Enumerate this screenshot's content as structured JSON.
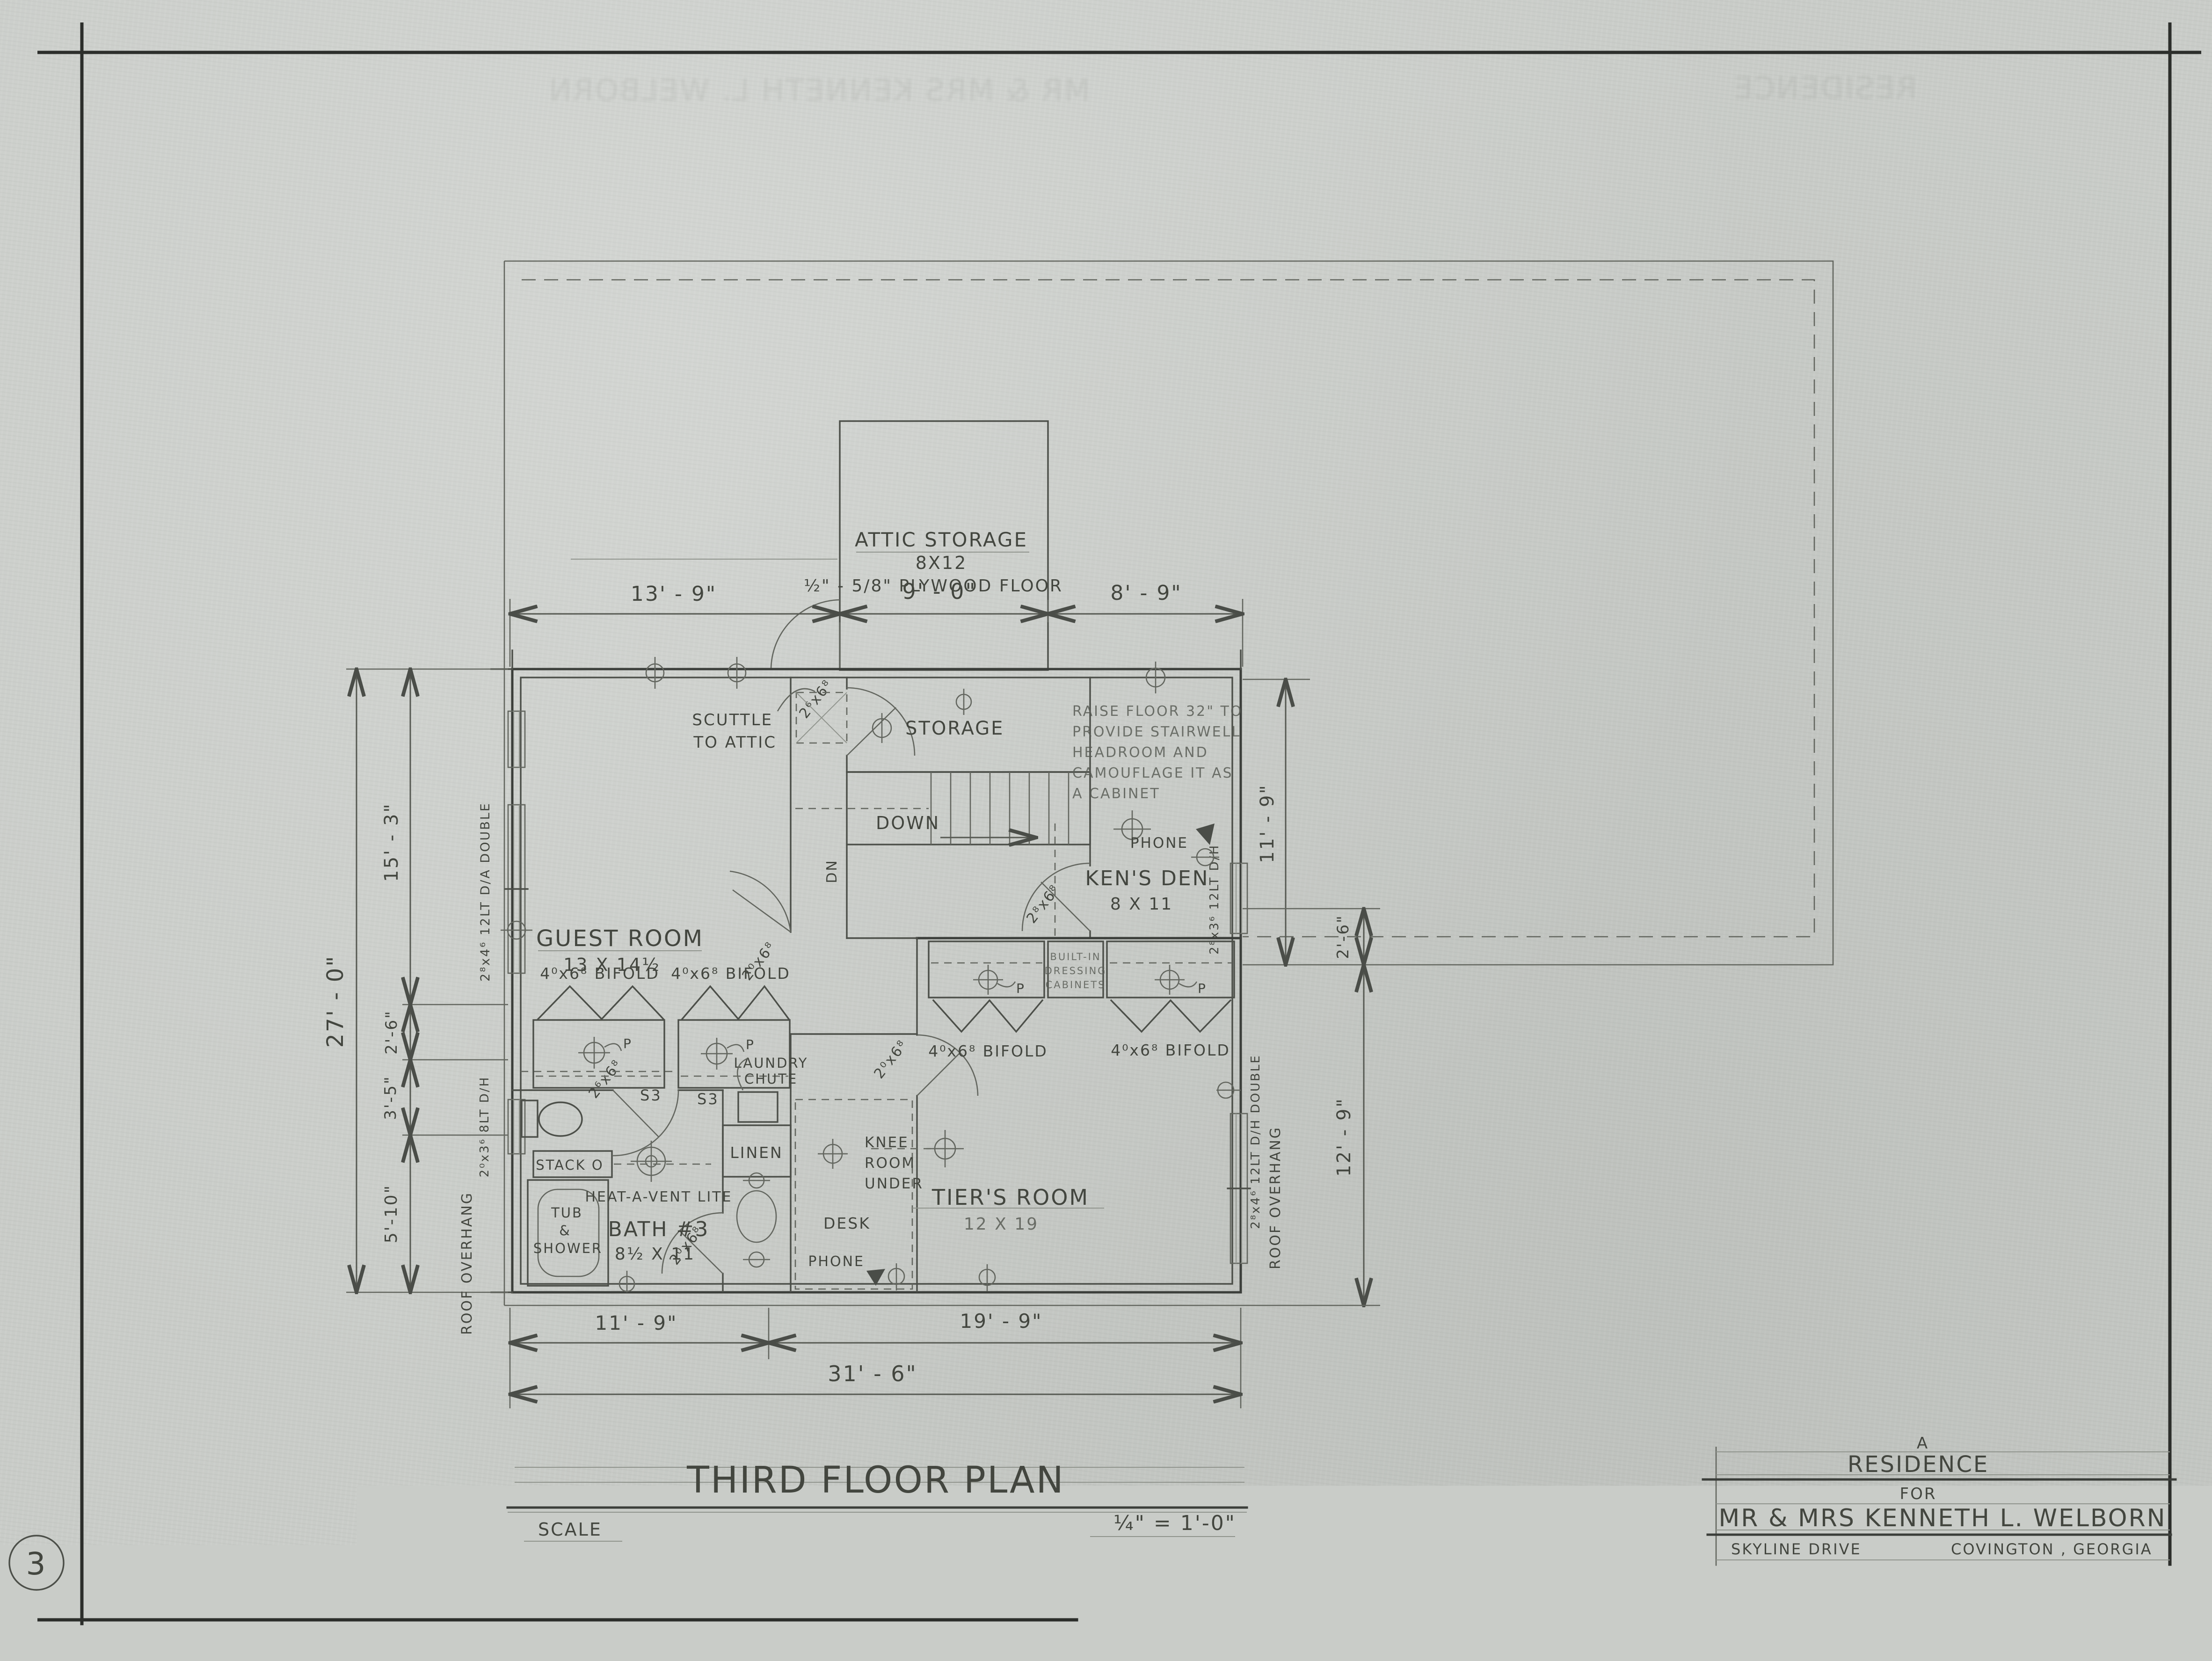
{
  "page": {
    "number": "3"
  },
  "title": {
    "name": "THIRD FLOOR PLAN",
    "scale_label": "SCALE",
    "scale_value": "¼\" = 1'-0\""
  },
  "title_block": {
    "a": "A",
    "residence": "RESIDENCE",
    "for": "FOR",
    "client": "MR & MRS KENNETH L. WELBORN",
    "street": "SKYLINE DRIVE",
    "city": "COVINGTON , GEORGIA",
    "designer": "CHARLES HARDEN",
    "designer_title": "DESIGNER",
    "designer_city": "MARIETTA, GEORGIA"
  },
  "rooms": {
    "attic": {
      "name": "ATTIC STORAGE",
      "size": "8X12",
      "note": "½\" - 5/8\" PLYWOOD FLOOR"
    },
    "guest": {
      "name": "GUEST ROOM",
      "size": "13 X 14½"
    },
    "storage": {
      "name": "STORAGE"
    },
    "den": {
      "name": "KEN'S DEN",
      "size": "8 X 11"
    },
    "tiers": {
      "name": "TIER'S ROOM",
      "size": "12 X 19"
    },
    "bath": {
      "name": "BATH #3",
      "size": "8½ X 11"
    },
    "linen": {
      "name": "LINEN"
    }
  },
  "notes": {
    "scuttle1": "SCUTTLE",
    "scuttle2": "TO ATTIC",
    "raise1": "RAISE FLOOR 32\" TO",
    "raise2": "PROVIDE STAIRWELL",
    "raise3": "HEADROOM AND",
    "raise4": "CAMOUFLAGE IT AS",
    "raise5": "A CABINET",
    "laundry1": "LAUNDRY",
    "laundry2": "CHUTE",
    "knee1": "KNEE",
    "knee2": "ROOM",
    "knee3": "UNDER",
    "desk": "DESK",
    "cab1": "BUILT-IN",
    "cab2": "DRESSING",
    "cab3": "CABINETS",
    "tub1": "TUB",
    "tub2": "&",
    "tub3": "SHOWER",
    "stack": "STACK O",
    "heatvent": "HEAT-A-VENT LITE",
    "down": "DOWN",
    "dn": "DN",
    "phone": "PHONE",
    "roof_overhang": "ROOF OVERHANG",
    "pull": "P",
    "s3": "S3"
  },
  "doors": {
    "guest": "2⁰x6⁸",
    "storage": "2⁶x6⁸",
    "den": "2⁸x6⁸",
    "bath": "2⁶x6⁸",
    "tier": "2⁰x6⁸",
    "hall": "2⁰x6⁸",
    "bifold": "4⁰x6⁸ BIFOLD"
  },
  "windows": {
    "left_double": "2⁸x4⁶ 12LT D/A DOUBLE",
    "left_bath": "2⁰x3⁶ 8LT D/H",
    "right_den": "2⁸x3⁶ 12LT D/H",
    "right_double": "2⁸x4⁶ 12LT D/H DOUBLE"
  },
  "dims": {
    "top1": "13' - 9\"",
    "top2": "9' - 0\"",
    "top3": "8' - 9\"",
    "left_total": "27' - 0\"",
    "left1": "15' - 3\"",
    "left2": "2'-6\"",
    "left3": "3'-5\"",
    "left4": "5'-10\"",
    "right1": "11' - 9\"",
    "right2": "2'-6\"",
    "right3": "12' - 9\"",
    "bottom1": "11' - 9\"",
    "bottom2": "19' - 9\"",
    "bottom_total": "31' - 6\""
  }
}
